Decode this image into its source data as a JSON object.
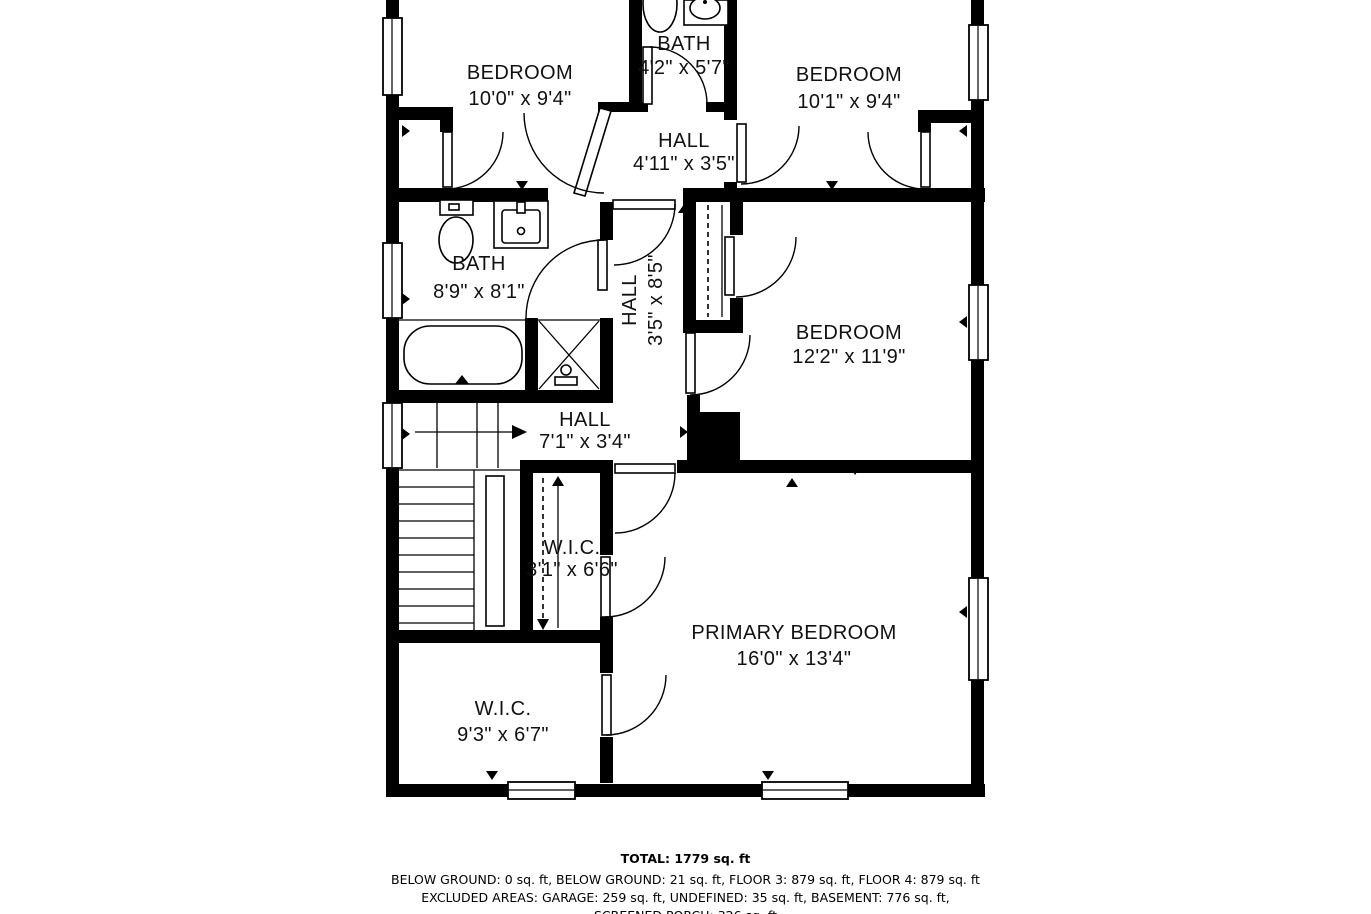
{
  "colors": {
    "walls": "#000000",
    "background": "#ffffff",
    "text": "#111111"
  },
  "rooms": {
    "bedroom_tl": {
      "label": "BEDROOM",
      "dims": "10'0\" x 9'4\""
    },
    "bath_top": {
      "label": "BATH",
      "dims": "4'2\" x 5'7\""
    },
    "bedroom_tr": {
      "label": "BEDROOM",
      "dims": "10'1\" x 9'4\""
    },
    "hall_top": {
      "label": "HALL",
      "dims": "4'11\" x 3'5\""
    },
    "bath_mid": {
      "label": "BATH",
      "dims": "8'9\" x 8'1\""
    },
    "hall_mid": {
      "label": "HALL",
      "dims": "3'5\" x 8'5\""
    },
    "bedroom_right": {
      "label": "BEDROOM",
      "dims": "12'2\" x 11'9\""
    },
    "hall_lower": {
      "label": "HALL",
      "dims": "7'1\" x 3'4\""
    },
    "wic_small": {
      "label": "W.I.C.",
      "dims": "3'1\" x 6'6\""
    },
    "primary_bedroom": {
      "label": "PRIMARY BEDROOM",
      "dims": "16'0\" x 13'4\""
    },
    "wic_large": {
      "label": "W.I.C.",
      "dims": "9'3\" x 6'7\""
    }
  },
  "summary": {
    "total": "TOTAL: 1779 sq. ft",
    "line1": "BELOW GROUND: 0 sq. ft, BELOW GROUND: 21 sq. ft, FLOOR 3: 879 sq. ft, FLOOR 4: 879 sq. ft",
    "line2": "EXCLUDED AREAS: GARAGE: 259 sq. ft, UNDEFINED: 35 sq. ft, BASEMENT: 776 sq. ft,",
    "line3": "SCREENED PORCH: 326 sq. ft"
  }
}
